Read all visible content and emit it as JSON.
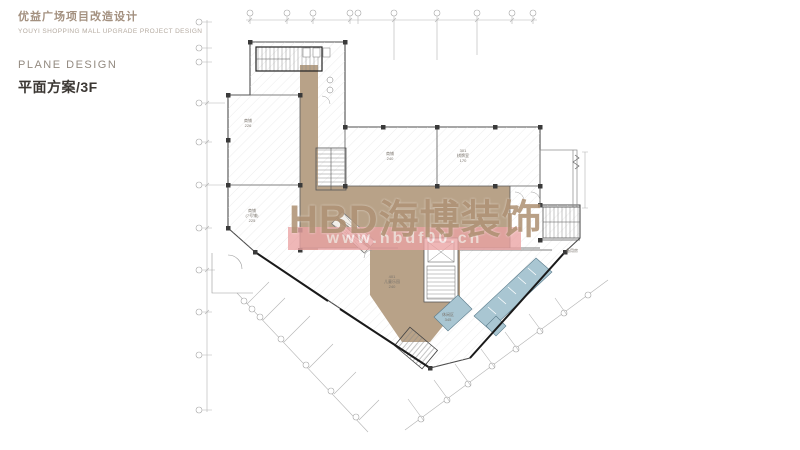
{
  "header": {
    "project_title_cn": "优益广场项目改造设计",
    "project_title_en": "YOUYI SHOPPING MALL UPGRADE PROJECT DESIGN",
    "section_label_en": "PLANE DESIGN",
    "section_label_cn": "平面方案/3F"
  },
  "watermark": {
    "brand": "HBD海博装饰",
    "url": "www.hbdf00.cn"
  },
  "plan": {
    "floor": "3F",
    "rooms": [
      {
        "label": [
          "商铺",
          "226"
        ]
      },
      {
        "label": [
          "商铺",
          "(7号铺)",
          "225"
        ]
      },
      {
        "label": [
          "商铺",
          "240"
        ]
      },
      {
        "label": [
          "301",
          "棋牌室",
          "170"
        ]
      },
      {
        "label": [
          "401",
          "儿童乐园",
          "240"
        ]
      },
      {
        "label": [
          "休闲区",
          "345"
        ]
      },
      {
        "label": [
          "备用房"
        ]
      }
    ],
    "colors": {
      "corridor": "#b8a288",
      "wet_area": "#a9c6d2",
      "wall": "#4d4d4d",
      "hatch": "#dcdcdc",
      "dimension": "#b3b3b3",
      "watermark_tan": "#b09376",
      "watermark_pink": "#eba3a3"
    }
  }
}
